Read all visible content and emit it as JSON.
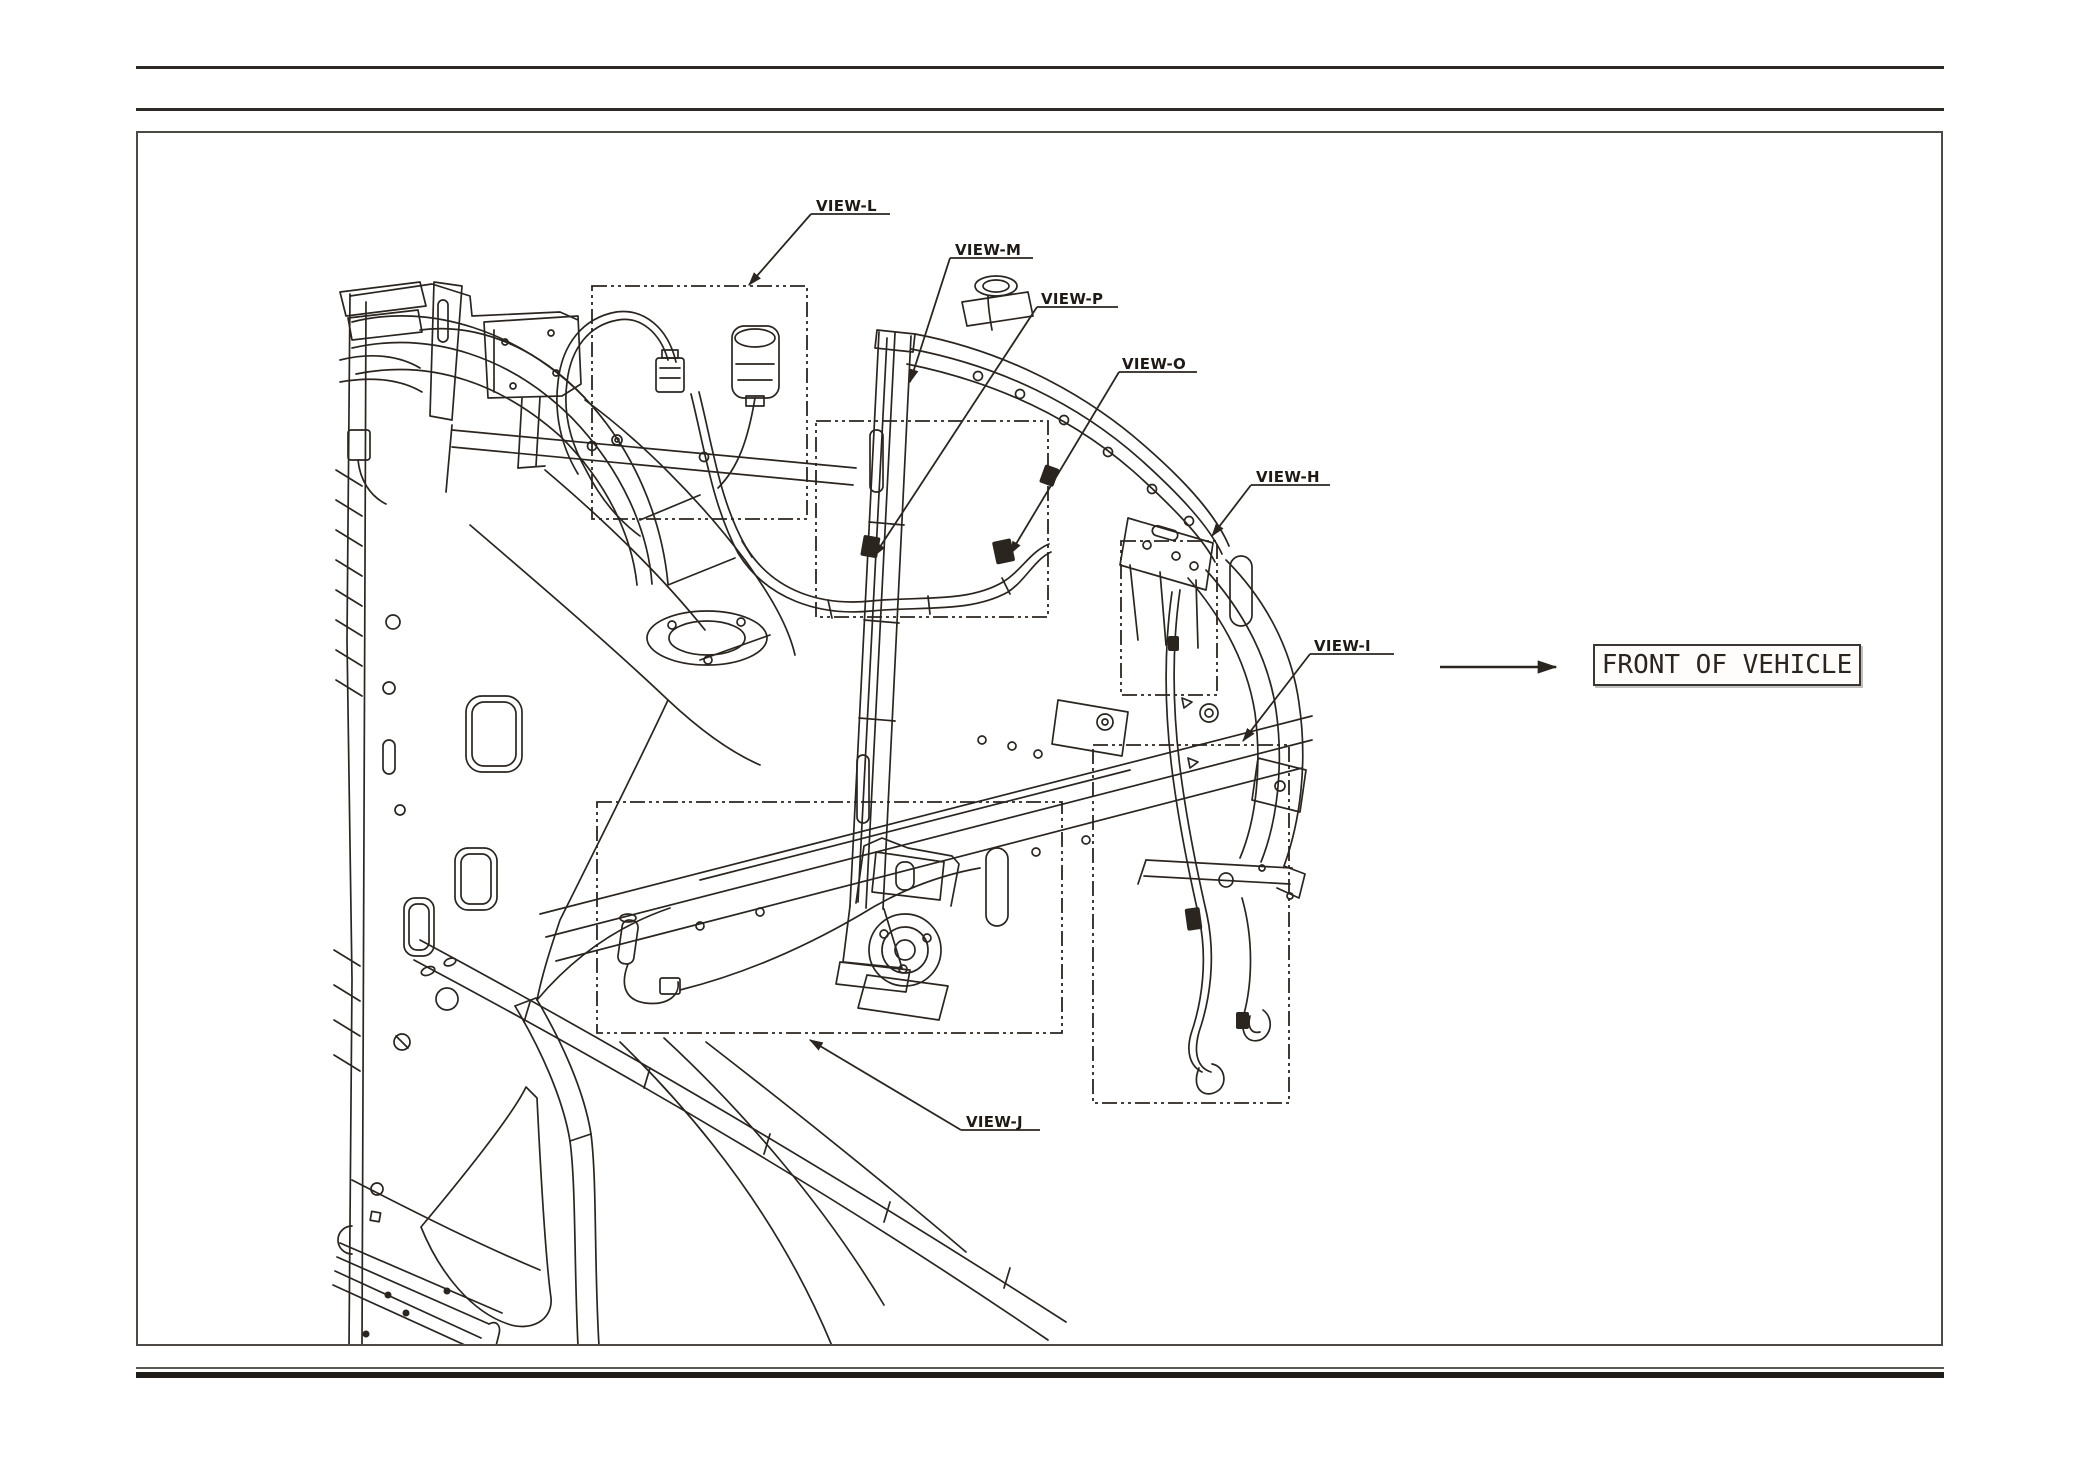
{
  "document": {
    "type": "technical-illustration-page",
    "callouts": [
      {
        "id": "view-l",
        "label": "VIEW-L"
      },
      {
        "id": "view-m",
        "label": "VIEW-M"
      },
      {
        "id": "view-p",
        "label": "VIEW-P"
      },
      {
        "id": "view-o",
        "label": "VIEW-O"
      },
      {
        "id": "view-h",
        "label": "VIEW-H"
      },
      {
        "id": "view-i",
        "label": "VIEW-I"
      },
      {
        "id": "view-j",
        "label": "VIEW-J"
      }
    ],
    "direction_indicator": {
      "label": "FRONT OF VEHICLE"
    },
    "colors": {
      "ink": "#2b2520",
      "paper": "#ffffff",
      "frame_border": "#4d4944"
    }
  }
}
